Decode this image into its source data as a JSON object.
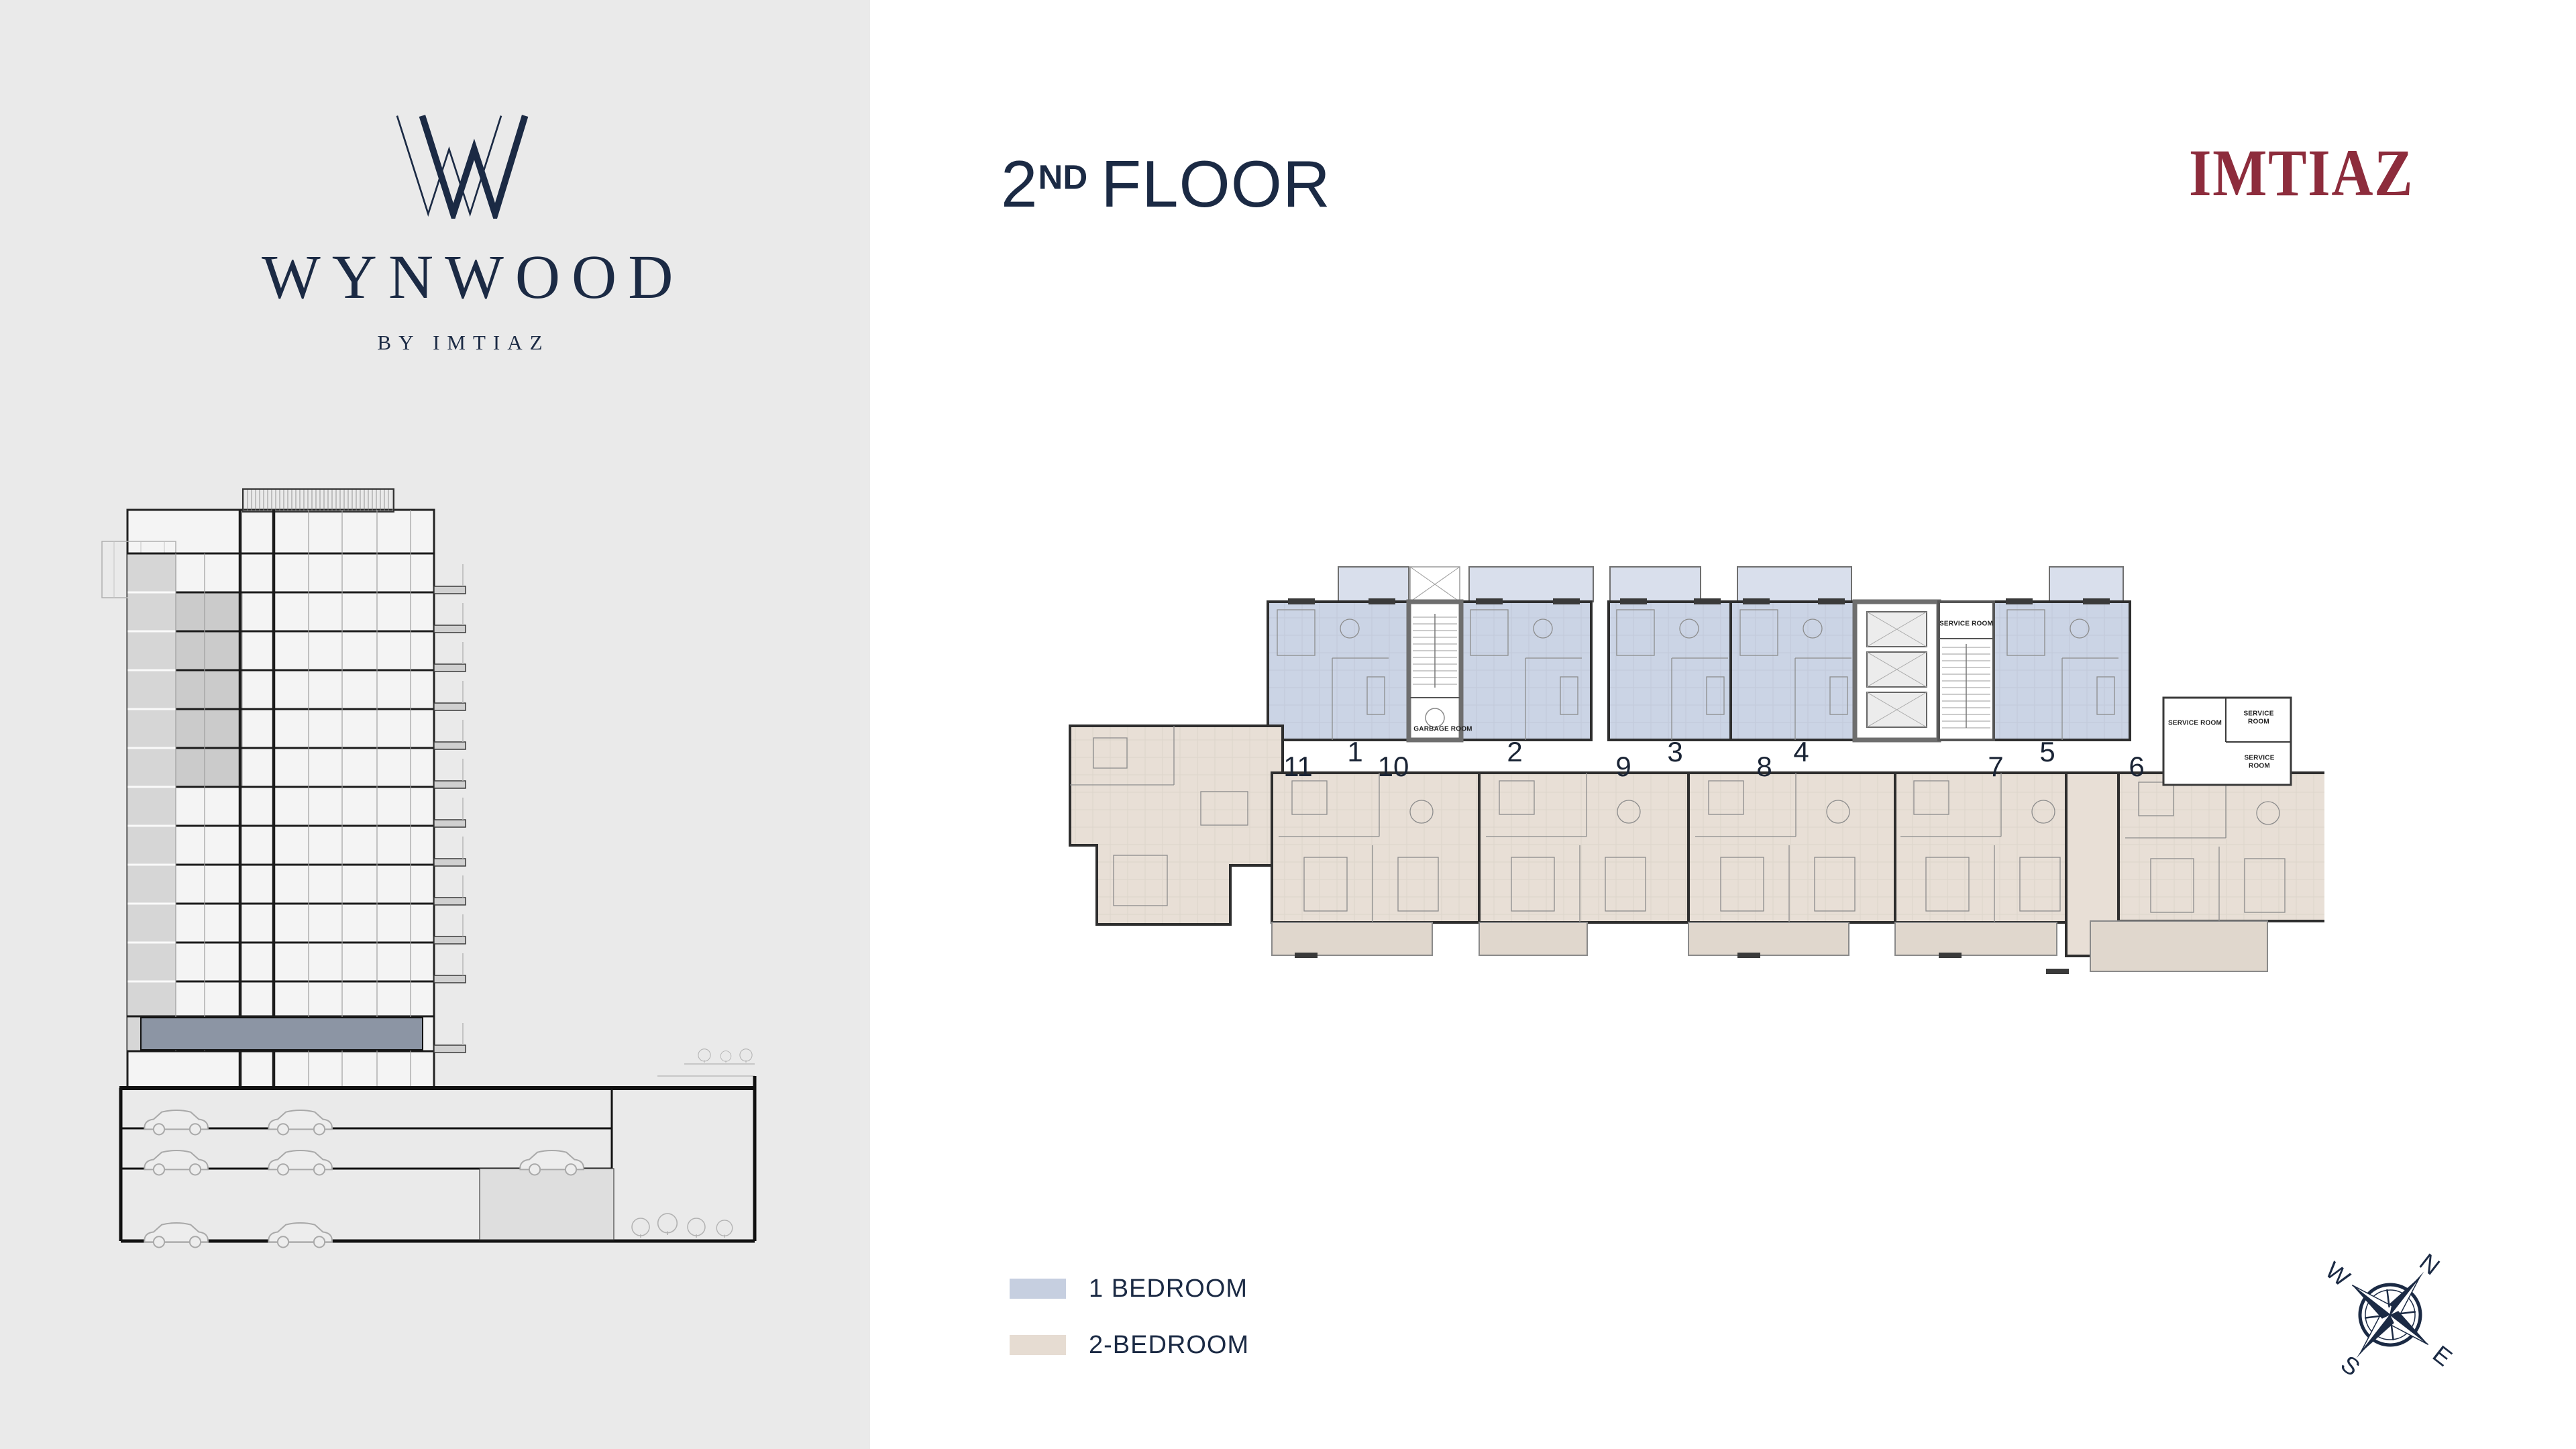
{
  "page": {
    "sidebar_bg": "#eaeaea",
    "canvas_bg": "#ffffff",
    "navy": "#1b2a44"
  },
  "sidebar": {
    "logo": {
      "name": "WYNWOOD",
      "tagline": "BY IMTIAZ",
      "monogram_icon": "double-w-monogram"
    }
  },
  "header": {
    "floor_number": "2",
    "floor_ordinal": "ND",
    "floor_word": "FLOOR"
  },
  "brand": {
    "name": "IMTIAZ",
    "color": "#8d2c3c"
  },
  "floor_plan": {
    "colors": {
      "one_bedroom": "#cbd4e5",
      "one_bedroom_balcony": "#d9dfec",
      "two_bedroom": "#e8dfd6",
      "two_bedroom_balcony": "#e0d7cd",
      "wall": "#2e2e2e",
      "core_wall": "#6e6e6e"
    },
    "corridor_numbers": [
      {
        "label": "11"
      },
      {
        "label": "1"
      },
      {
        "label": "10"
      },
      {
        "label": "2"
      },
      {
        "label": "9"
      },
      {
        "label": "3"
      },
      {
        "label": "8"
      },
      {
        "label": "4"
      },
      {
        "label": "7"
      },
      {
        "label": "5"
      },
      {
        "label": "6"
      }
    ],
    "room_labels": {
      "garbage_room": "GARBAGE ROOM",
      "service_room": "SERVICE ROOM"
    }
  },
  "legend": {
    "items": [
      {
        "label": "1 BEDROOM",
        "color": "#c6cfe0"
      },
      {
        "label": "2-BEDROOM",
        "color": "#e6dcd2"
      }
    ]
  },
  "compass": {
    "north": "N",
    "east": "E",
    "south": "S",
    "west": "W",
    "rotation_deg": 38
  },
  "section": {
    "highlight_color": "#8c95a4"
  }
}
